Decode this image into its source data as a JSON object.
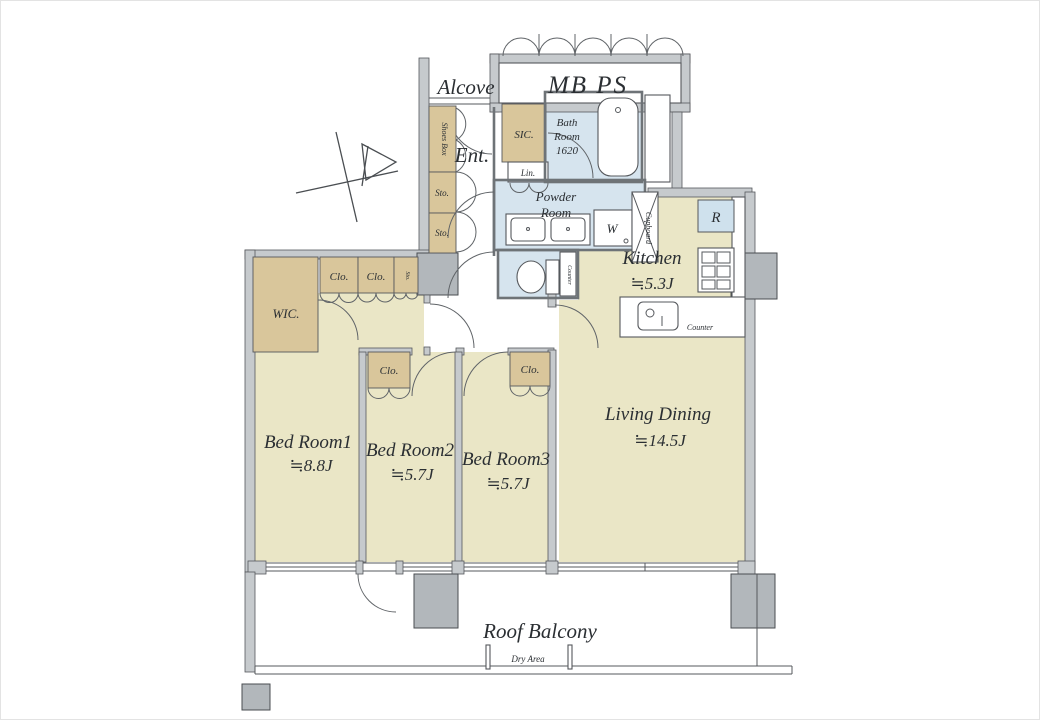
{
  "colors": {
    "wall": "#c6cacd",
    "pillar": "#b2b7bb",
    "floor-tan": "#eae6c6",
    "closet-tan": "#d9c69b",
    "wet-blue": "#d6e4ee",
    "line": "#55585c",
    "text": "#2b2f33"
  },
  "labels": {
    "alcove": "Alcove",
    "mbps": "MB PS",
    "ent": "Ent.",
    "shoes_box": "Shoes Box",
    "sto_a": "Sto.",
    "sto_b": "Sto.",
    "sic": "SIC.",
    "lin": "Lin.",
    "bath_1": "Bath",
    "bath_2": "Room",
    "bath_3": "1620",
    "powder_1": "Powder",
    "powder_2": "Room",
    "washer": "W",
    "toilet_counter": "Counter",
    "cupboard": "Cupboard",
    "fridge": "R",
    "kitchen_name": "Kitchen",
    "kitchen_size": "≒5.3J",
    "kitchen_counter": "Counter",
    "living_name": "Living Dining",
    "living_size": "≒14.5J",
    "wic": "WIC.",
    "clo_1": "Clo.",
    "clo_2": "Clo.",
    "sto_small": "Sto.",
    "bed1_name": "Bed Room1",
    "bed1_size": "≒8.8J",
    "clo_bed2": "Clo.",
    "bed2_name": "Bed Room2",
    "bed2_size": "≒5.7J",
    "clo_bed3": "Clo.",
    "bed3_name": "Bed Room3",
    "bed3_size": "≒5.7J",
    "balcony": "Roof Balcony",
    "dry_area": "Dry Area"
  }
}
